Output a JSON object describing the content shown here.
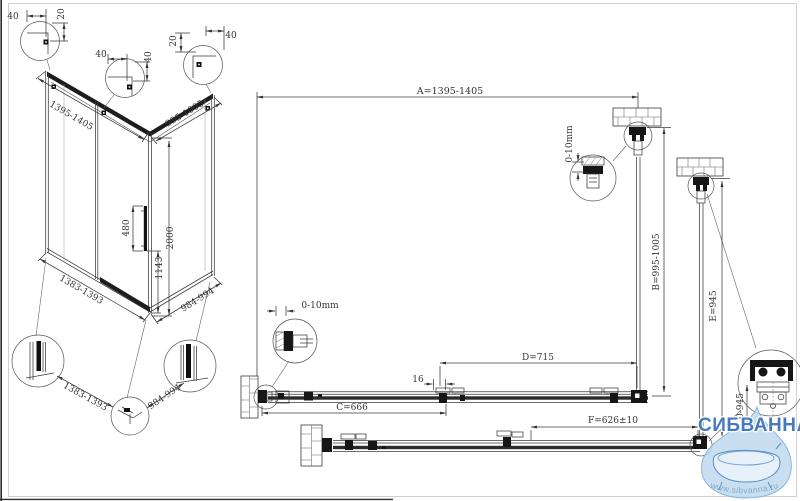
{
  "isometric": {
    "corner_details": [
      {
        "h": "40",
        "v": "20"
      },
      {
        "h": "40",
        "v": "40"
      },
      {
        "v": "20",
        "h": "40"
      }
    ],
    "top_width": "1395-1405",
    "top_depth": "995-1005",
    "handle_length": "480",
    "height": "2000",
    "handle_height": "1143",
    "bottom_width": "1383-1393",
    "bottom_depth": "984-994",
    "profile_detail_width": "1383-1393",
    "profile_detail_depth": "984-994"
  },
  "plan": {
    "dim_a": "A=1395-1405",
    "dim_b": "B=995-1005",
    "dim_c": "C=666",
    "dim_d": "D=715",
    "dim_e": "E=945",
    "dim_f": "F=626±10",
    "gap": "16",
    "wall_adjust_top": "0-10mm",
    "wall_adjust_left": "0-10mm",
    "corner_detail_dim": "0-945"
  },
  "watermark": {
    "brand": "СИБВАННА",
    "url": "www.sibvanna.ru",
    "accent_color": "#4779c0",
    "drop_color": "#bcd8ee"
  }
}
